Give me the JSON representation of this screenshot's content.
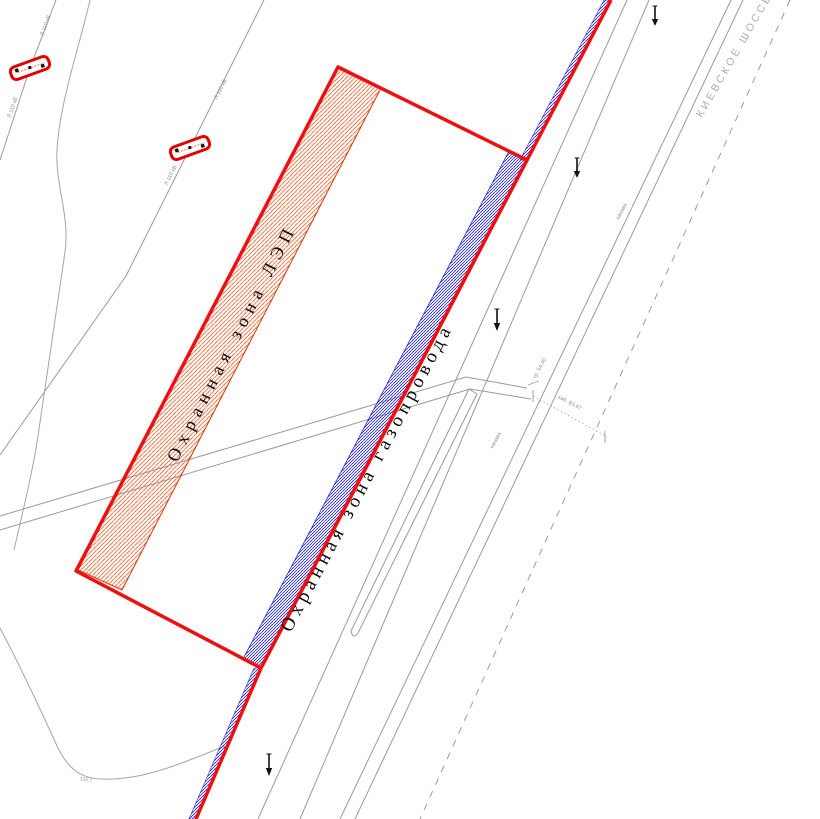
{
  "labels": {
    "lep_zone": "Охранная зона ЛЭП",
    "gas_zone": "Охранная зона газопровода",
    "highway": "КИЕВСКОЕ ШОССЕ"
  },
  "micro": {
    "powerline1_top": "Л 110 кВ",
    "powerline1_bottom": "Л 110 кВ",
    "powerline2_top": "Л 110 кВ",
    "powerline2_bottom": "Л 110 кВ",
    "pipe_mark": "тр. 54,40",
    "cable_mark": "каб. 83,47",
    "ditch1": "канава",
    "ditch2": "канава",
    "elevation": "132.7"
  },
  "colors": {
    "parcel_red": "#ee1010",
    "lep_hatch_orange": "#e4602c",
    "gas_hatch_blue": "#2a2ad0",
    "linework_gray": "#9a9a9a",
    "label_black": "#0a0a0a",
    "highway_gray": "#ababab"
  }
}
